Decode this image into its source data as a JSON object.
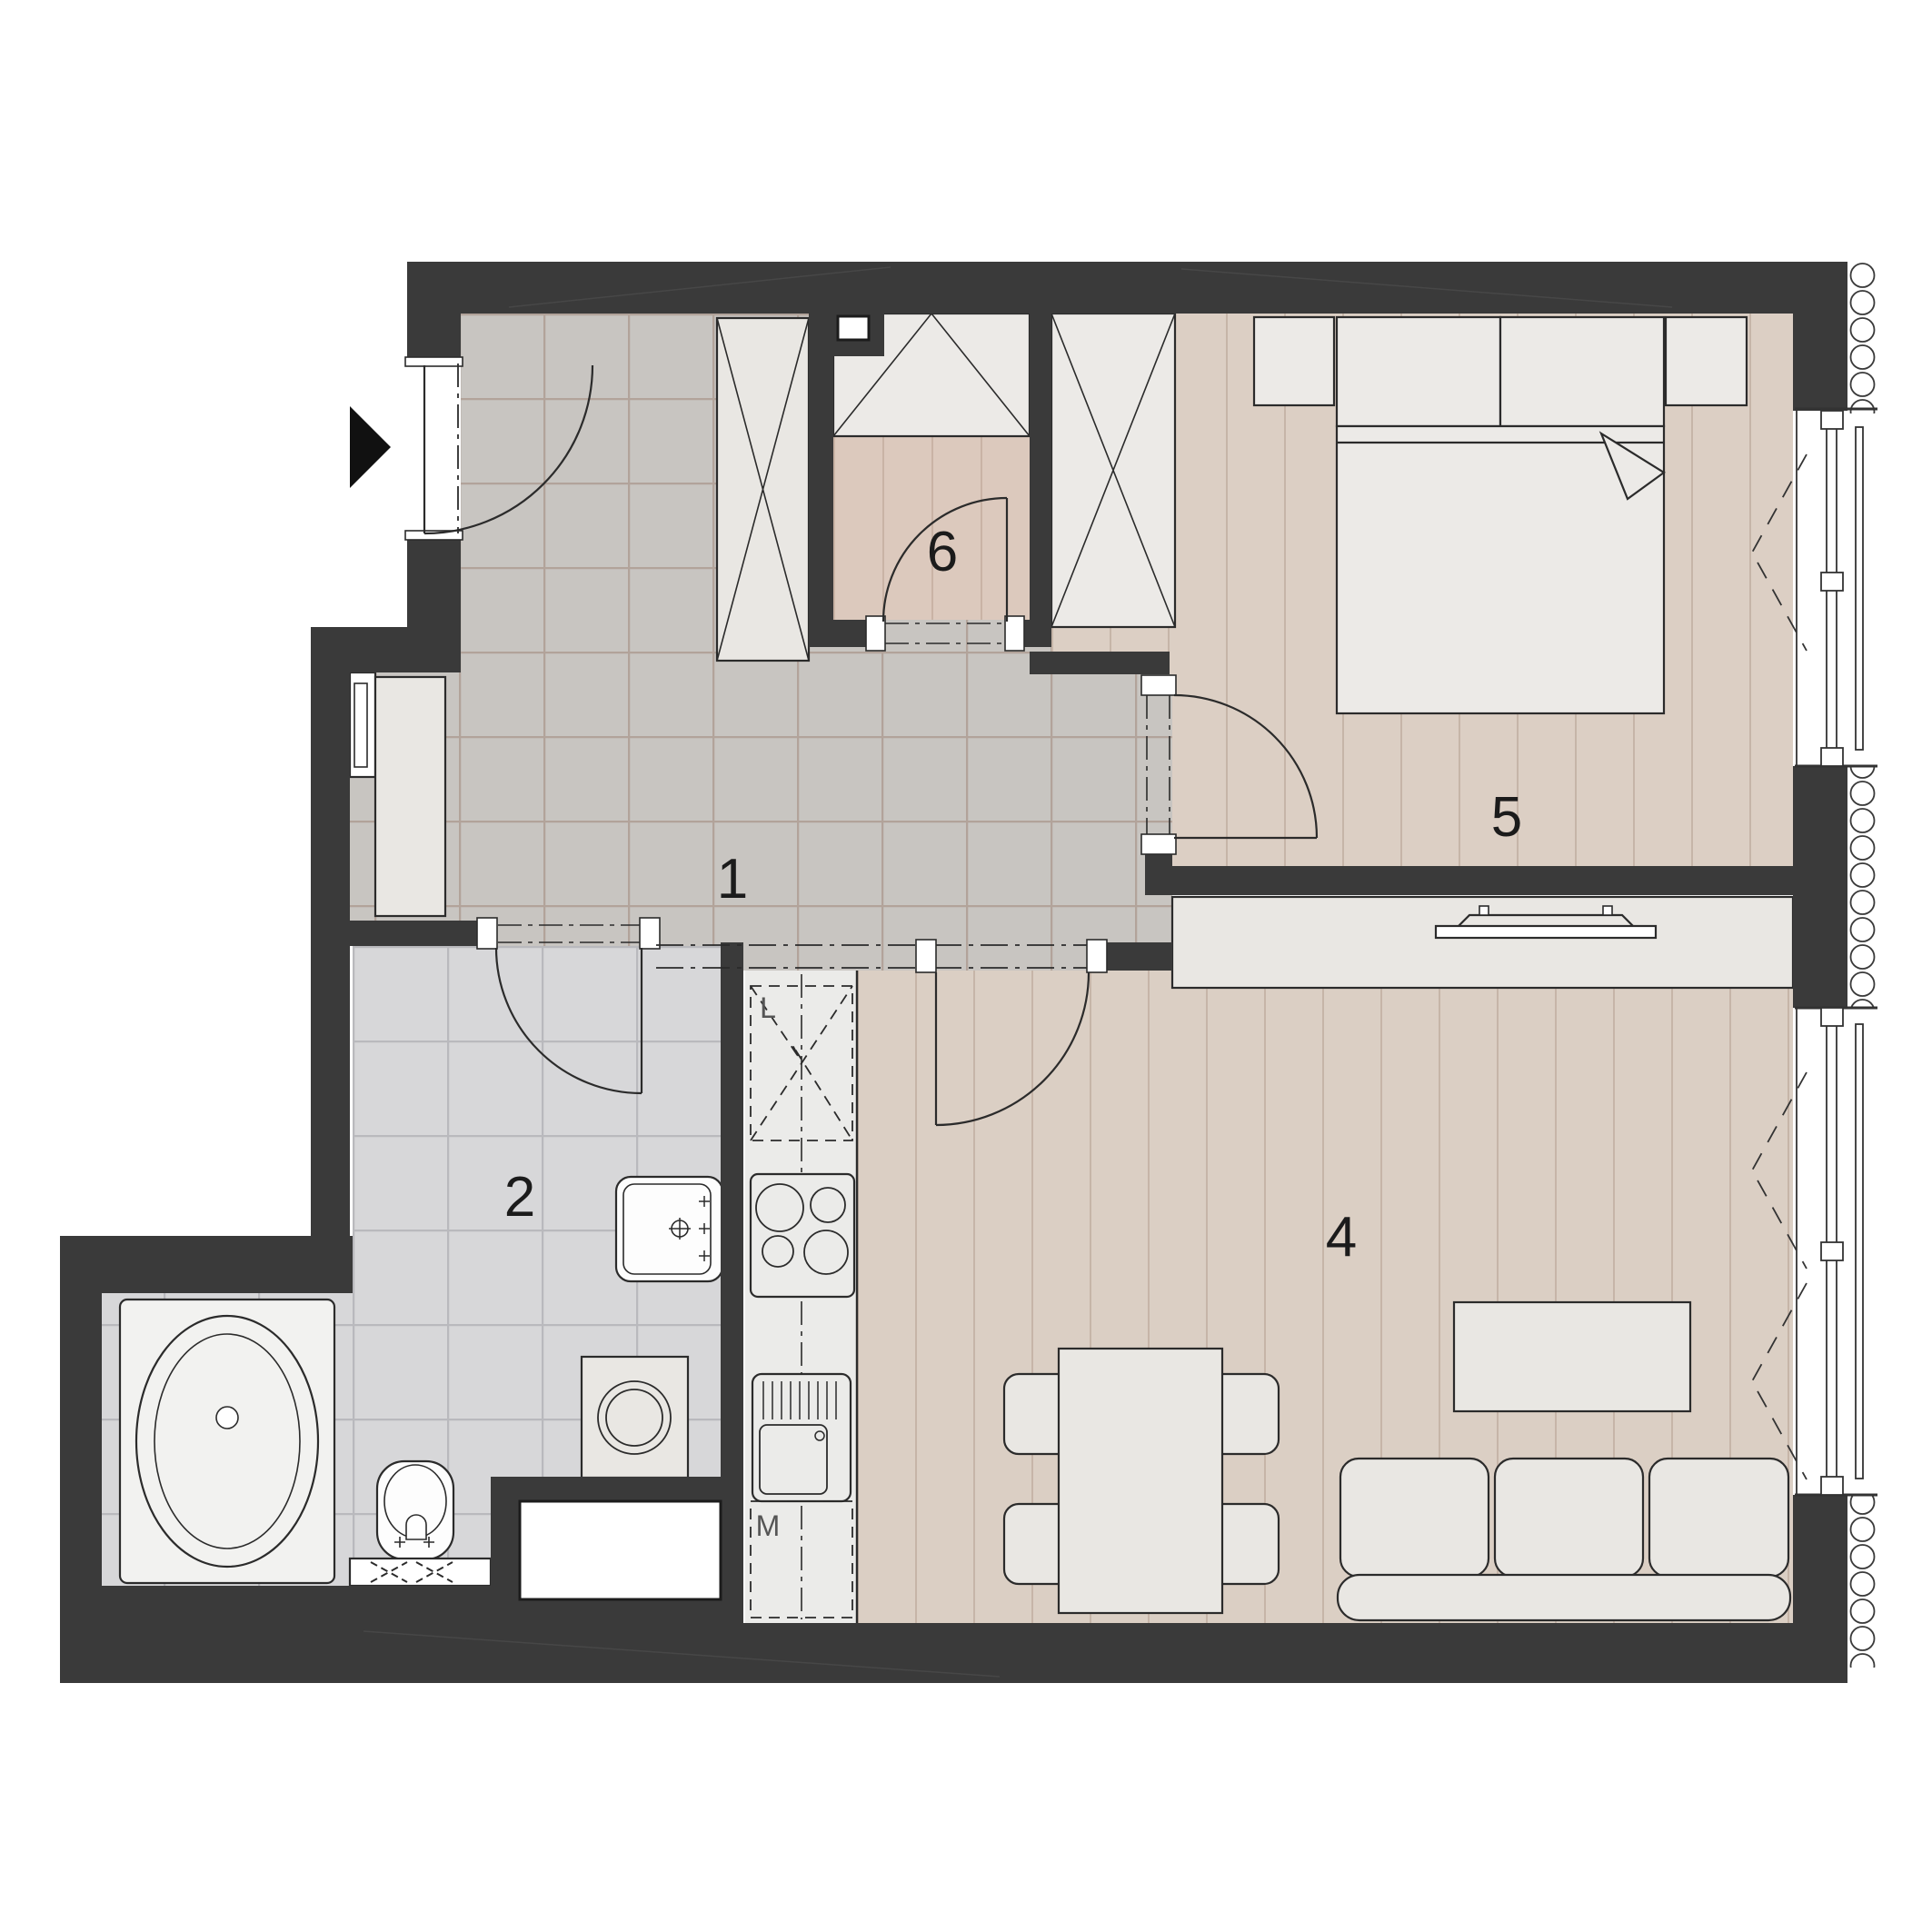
{
  "title": "Apartment floor plan",
  "rooms": [
    {
      "id": "hallway",
      "label": "1"
    },
    {
      "id": "bathroom",
      "label": "2"
    },
    {
      "id": "living-room-kitchen",
      "label": "4"
    },
    {
      "id": "bedroom",
      "label": "5"
    },
    {
      "id": "walk-in-closet",
      "label": "6"
    }
  ],
  "kitchen_units": {
    "fridge_label": "L",
    "dishwasher_label": "M"
  },
  "colors": {
    "wall": "#3a3a3a",
    "outline": "#2b2b2b",
    "hall_tile": "#c8c5c1",
    "hall_grout": "#b2a39a",
    "bath_tile": "#d7d7d9",
    "bath_grout": "#b9b9bd",
    "wood_floor": "#dbcfc4",
    "wood_line": "#c6b5a8",
    "closet_floor": "#dcc9bd",
    "closet_floor_line": "#c9b3a5",
    "counter": "#ebebe9",
    "furniture_fill": "#e9e7e3",
    "entry_arrow": "#111111",
    "background": "#ffffff"
  }
}
